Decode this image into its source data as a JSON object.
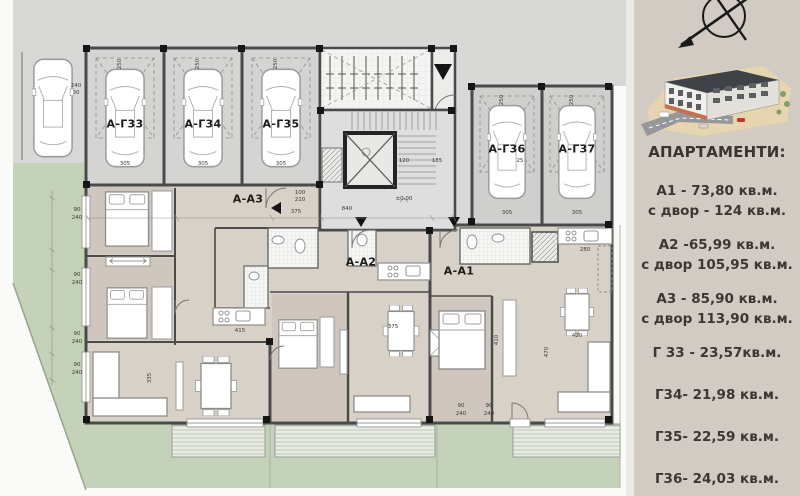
{
  "colors": {
    "street": "#d8d8d6",
    "garage_floor": "#d4d4d2",
    "garage_floor_right": "#cfcfcd",
    "apartment_floor": "#d8d1c8",
    "bedroom_floor": "#cfc7be",
    "yard_green": "#c4d2ba",
    "terrace": "#e9ece4",
    "wall": "#4a4a4a",
    "sidebar_bg": "#d2cbc3",
    "text_dark": "#38352f"
  },
  "plan": {
    "garage_labels": [
      {
        "text": "А-Г33",
        "x": 125,
        "y": 124
      },
      {
        "text": "А-Г34",
        "x": 203,
        "y": 124
      },
      {
        "text": "А-Г35",
        "x": 281,
        "y": 124
      },
      {
        "text": "А-Г36",
        "x": 507,
        "y": 149
      },
      {
        "text": "А-Г37",
        "x": 577,
        "y": 149
      }
    ],
    "apartment_labels": [
      {
        "text": "А-А3",
        "x": 248,
        "y": 199
      },
      {
        "text": "А-А2",
        "x": 361,
        "y": 262
      },
      {
        "text": "А-А1",
        "x": 459,
        "y": 271
      }
    ],
    "dims": [
      {
        "t": "305",
        "x": 125,
        "y": 164
      },
      {
        "t": "305",
        "x": 203,
        "y": 164
      },
      {
        "t": "305",
        "x": 281,
        "y": 164
      },
      {
        "t": "305",
        "x": 507,
        "y": 213
      },
      {
        "t": "305",
        "x": 577,
        "y": 213
      },
      {
        "t": "250",
        "x": 120,
        "y": 64,
        "rot": true
      },
      {
        "t": "250",
        "x": 198,
        "y": 64,
        "rot": true
      },
      {
        "t": "250",
        "x": 276,
        "y": 64,
        "rot": true
      },
      {
        "t": "250",
        "x": 502,
        "y": 100,
        "rot": true
      },
      {
        "t": "250",
        "x": 572,
        "y": 100,
        "rot": true
      },
      {
        "t": "240",
        "x": 76,
        "y": 86
      },
      {
        "t": "30",
        "x": 76,
        "y": 93
      },
      {
        "t": "90",
        "x": 77,
        "y": 210
      },
      {
        "t": "240",
        "x": 77,
        "y": 218
      },
      {
        "t": "90",
        "x": 77,
        "y": 275
      },
      {
        "t": "240",
        "x": 77,
        "y": 283
      },
      {
        "t": "90",
        "x": 77,
        "y": 334
      },
      {
        "t": "240",
        "x": 77,
        "y": 342
      },
      {
        "t": "90",
        "x": 77,
        "y": 365
      },
      {
        "t": "240",
        "x": 77,
        "y": 373
      },
      {
        "t": "375",
        "x": 296,
        "y": 212
      },
      {
        "t": "840",
        "x": 347,
        "y": 209
      },
      {
        "t": "100",
        "x": 300,
        "y": 193
      },
      {
        "t": "210",
        "x": 300,
        "y": 200
      },
      {
        "t": "±0.00",
        "x": 404,
        "y": 199
      },
      {
        "t": "120",
        "x": 404,
        "y": 161
      },
      {
        "t": "185",
        "x": 437,
        "y": 161
      },
      {
        "t": "25",
        "x": 520,
        "y": 161
      },
      {
        "t": "415",
        "x": 240,
        "y": 331
      },
      {
        "t": "375",
        "x": 393,
        "y": 327
      },
      {
        "t": "420",
        "x": 577,
        "y": 336
      },
      {
        "t": "280",
        "x": 585,
        "y": 250
      },
      {
        "t": "335",
        "x": 150,
        "y": 378,
        "rot": true
      },
      {
        "t": "470",
        "x": 547,
        "y": 352,
        "rot": true
      },
      {
        "t": "410",
        "x": 497,
        "y": 340,
        "rot": true
      },
      {
        "t": "90",
        "x": 461,
        "y": 406
      },
      {
        "t": "240",
        "x": 461,
        "y": 414
      },
      {
        "t": "90",
        "x": 489,
        "y": 406
      },
      {
        "t": "240",
        "x": 489,
        "y": 414
      }
    ]
  },
  "sidebar": {
    "heading": "АПАРТАМЕНТИ:",
    "items": [
      {
        "line1": "А1 - 73,80 кв.м.",
        "line2": "с двор - 124 кв.м."
      },
      {
        "line1": "А2 -65,99 кв.м.",
        "line2": "с двор 105,95 кв.м."
      },
      {
        "line1": "А3 - 85,90 кв.м.",
        "line2": "с двор 113,90 кв.м."
      },
      {
        "line1": "Г 33 - 23,57кв.м.",
        "line2": ""
      },
      {
        "line1": "Г34- 21,98 кв.м.",
        "line2": ""
      },
      {
        "line1": "Г35- 22,59 кв.м.",
        "line2": ""
      },
      {
        "line1": "Г36- 24,03 кв.м.",
        "line2": ""
      }
    ]
  }
}
